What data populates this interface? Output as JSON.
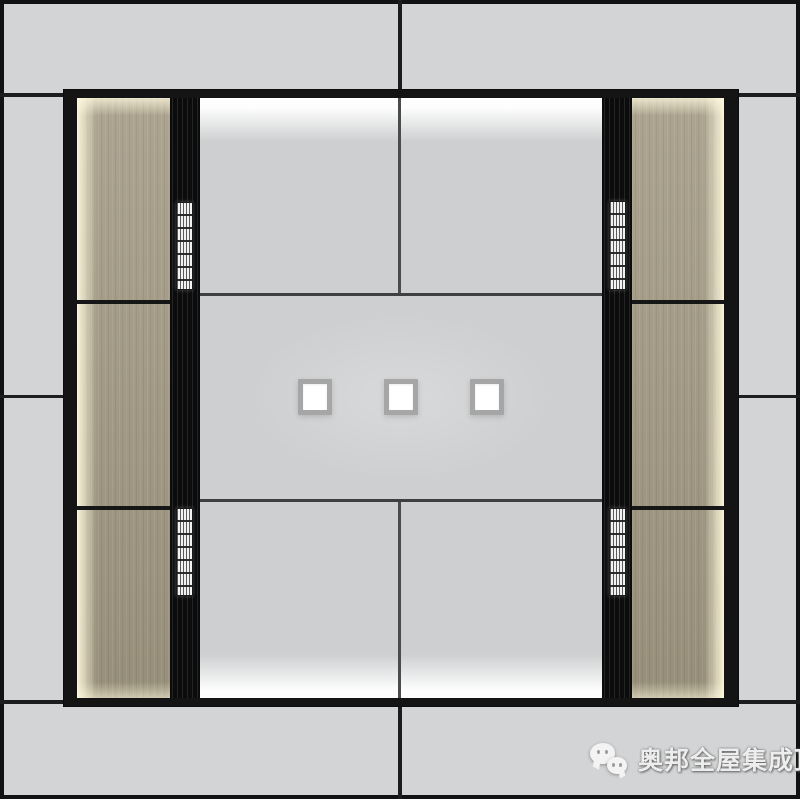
{
  "watermark": {
    "text": "奥邦全屋集成顶",
    "icon": "wechat"
  },
  "scene": {
    "type": "integrated-ceiling-design-render",
    "recessed_lights_count": 3,
    "vent_grilles_count": 4,
    "wood_panels_per_side": 3
  },
  "colors": {
    "outer_panel_gray": "#d3d4d5",
    "center_panel_gray": "#cdcfd0",
    "grid_black": "#161616",
    "wood_tan": "#a39a83",
    "cove_glow_white": "#ffffff",
    "vent_white": "#f2f2f2",
    "light_frame_gray": "#a6a6a6"
  }
}
